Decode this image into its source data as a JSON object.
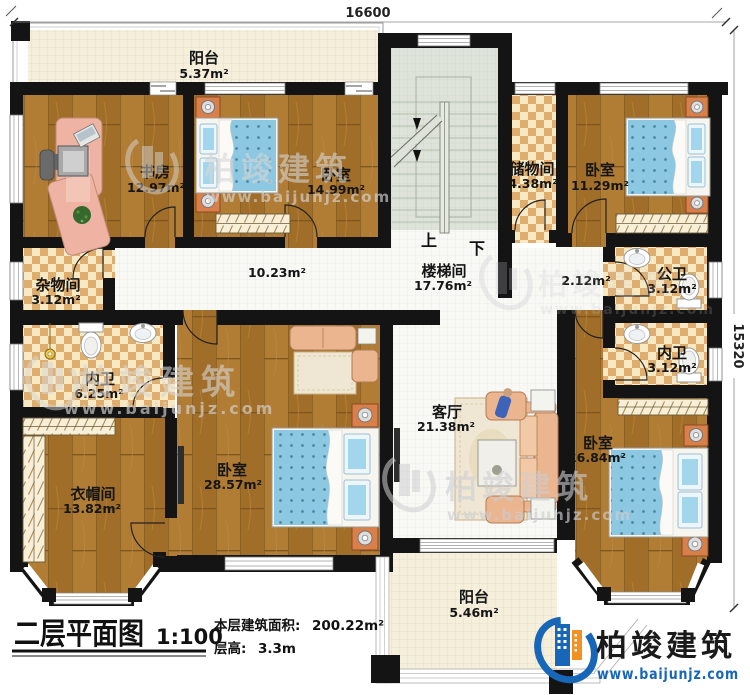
{
  "dimensions": {
    "top": "16600",
    "right": "15320"
  },
  "rooms": {
    "balcony_top": {
      "name": "阳台",
      "area": "5.37m²"
    },
    "study": {
      "name": "书房",
      "area": "12.97m²"
    },
    "bedroom_top": {
      "name": "卧室",
      "area": "14.99m²"
    },
    "storage": {
      "name": "储物间",
      "area": "4.38m²"
    },
    "bedroom_topright": {
      "name": "卧室",
      "area": "11.29m²"
    },
    "junk_room": {
      "name": "杂物间",
      "area": "3.12m²"
    },
    "hallway": {
      "area": "10.23m²"
    },
    "stairwell": {
      "name": "楼梯间",
      "area": "17.76m²",
      "up": "上",
      "down": "下"
    },
    "hallway2": {
      "area": "2.12m²"
    },
    "bath_public": {
      "name": "公卫",
      "area": "3.12m²"
    },
    "bath_ensuite_right": {
      "name": "内卫",
      "area": "3.12m²"
    },
    "bath_ensuite_left": {
      "name": "内卫",
      "area": "6.25m²"
    },
    "cloakroom": {
      "name": "衣帽间",
      "area": "13.82m²"
    },
    "bedroom_master": {
      "name": "卧室",
      "area": "28.57m²"
    },
    "living_room": {
      "name": "客厅",
      "area": "21.38m²"
    },
    "bedroom_right": {
      "name": "卧室",
      "area": "16.84m²"
    },
    "balcony_bottom": {
      "name": "阳台",
      "area": "5.46m²"
    }
  },
  "title_block": {
    "title": "二层平面图",
    "scale": "1:100",
    "floor_area_label": "本层建筑面积:",
    "floor_area_value": "200.22m²",
    "floor_height_label": "层高:",
    "floor_height_value": "3.3m"
  },
  "brand": {
    "name": "柏竣建筑",
    "website": "www.baijunjz.com"
  },
  "colors": {
    "wall": "#141414",
    "wood": "#a9762e",
    "checker_light": "#f6e9c3",
    "checker_dark": "#dfae6e",
    "mattress_blue": "#8cc8e2",
    "furniture_orange": "#d97f49",
    "logo_blue": "#1766b8",
    "logo_orange": "#f29122"
  }
}
